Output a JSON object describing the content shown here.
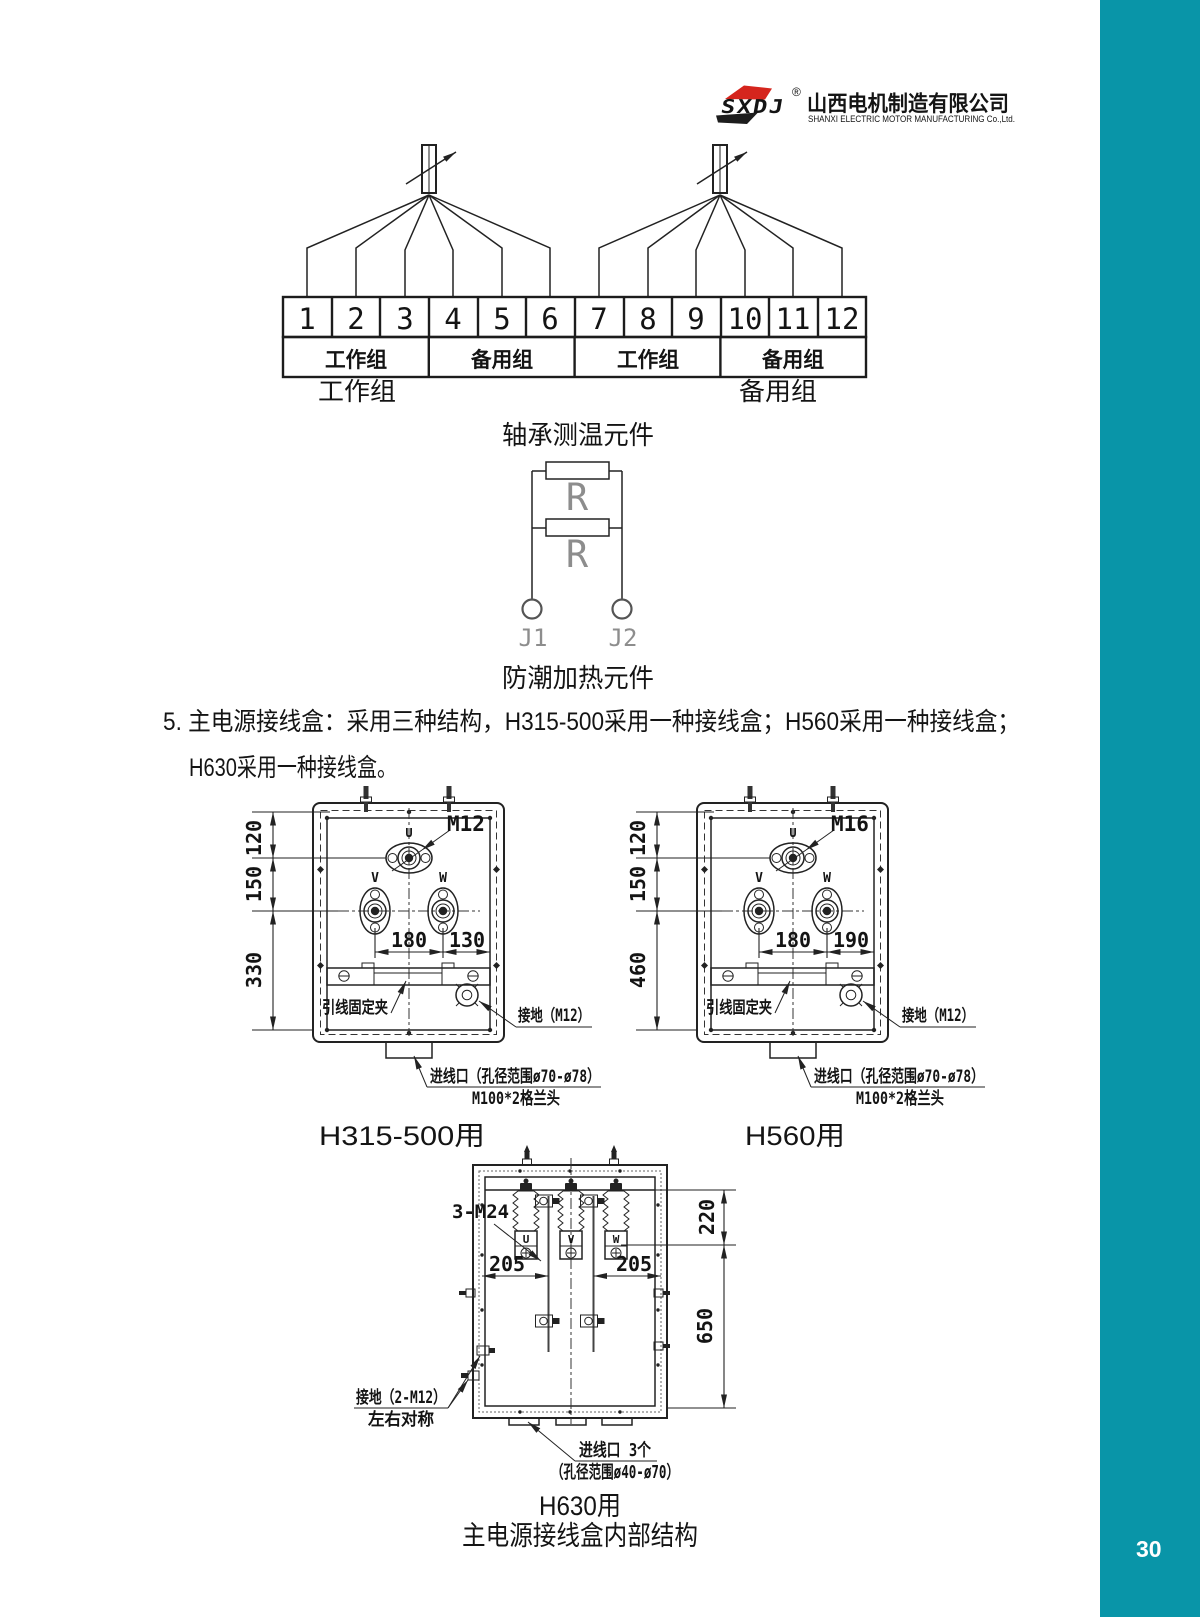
{
  "page": {
    "number": "30"
  },
  "colors": {
    "accent": "#0995a8",
    "logo_red": "#d5251d",
    "line": "#222222"
  },
  "logo": {
    "brand": "SXDJ",
    "registered": "®",
    "company_cn": "山西电机制造有限公司",
    "company_en": "SHANXI ELECTRIC MOTOR MANUFACTURING Co.,Ltd."
  },
  "bearing": {
    "terminals": [
      "1",
      "2",
      "3",
      "4",
      "5",
      "6",
      "7",
      "8",
      "9",
      "10",
      "11",
      "12"
    ],
    "row_groups": [
      "工作组",
      "备用组",
      "工作组",
      "备用组"
    ],
    "left_group_label": "工作组",
    "right_group_label": "备用组",
    "caption": "轴承测温元件"
  },
  "heater": {
    "r1": "R",
    "r2": "R",
    "j1": "J1",
    "j2": "J2",
    "caption": "防潮加热元件"
  },
  "section5": {
    "line1": "5. 主电源接线盒：采用三种结构，H315-500采用一种接线盒；H560采用一种接线盒；",
    "line2": "H630采用一种接线盒。"
  },
  "jbox": {
    "u": "U",
    "v": "V",
    "w": "W",
    "dim_top": "120",
    "dim_mid": "150",
    "dim_vw": "180",
    "clamp_label": "引线固定夹",
    "ground_label": "接地（M12）",
    "entry_line1": "进线口（孔径范围ø70-ø78）",
    "entry_line2": "M100*2格兰头"
  },
  "box_h315": {
    "stud_label": "M12",
    "dim_right": "130",
    "dim_bottom": "330",
    "caption": "H315-500用"
  },
  "box_h560": {
    "stud_label": "M16",
    "dim_right": "190",
    "dim_bottom": "460",
    "caption": "H560用"
  },
  "box_h630": {
    "stud_label": "3-M24",
    "terminals": [
      "U",
      "V",
      "W"
    ],
    "dim_left": "205",
    "dim_right": "205",
    "dim_top_right": "220",
    "dim_bottom_right": "650",
    "ground_line1": "接地（2-M12）",
    "ground_line2": "左右对称",
    "entry_line1": "进线口 3个",
    "entry_line2": "（孔径范围ø40-ø70）",
    "caption": "H630用"
  },
  "footer": {
    "caption": "主电源接线盒内部结构"
  }
}
